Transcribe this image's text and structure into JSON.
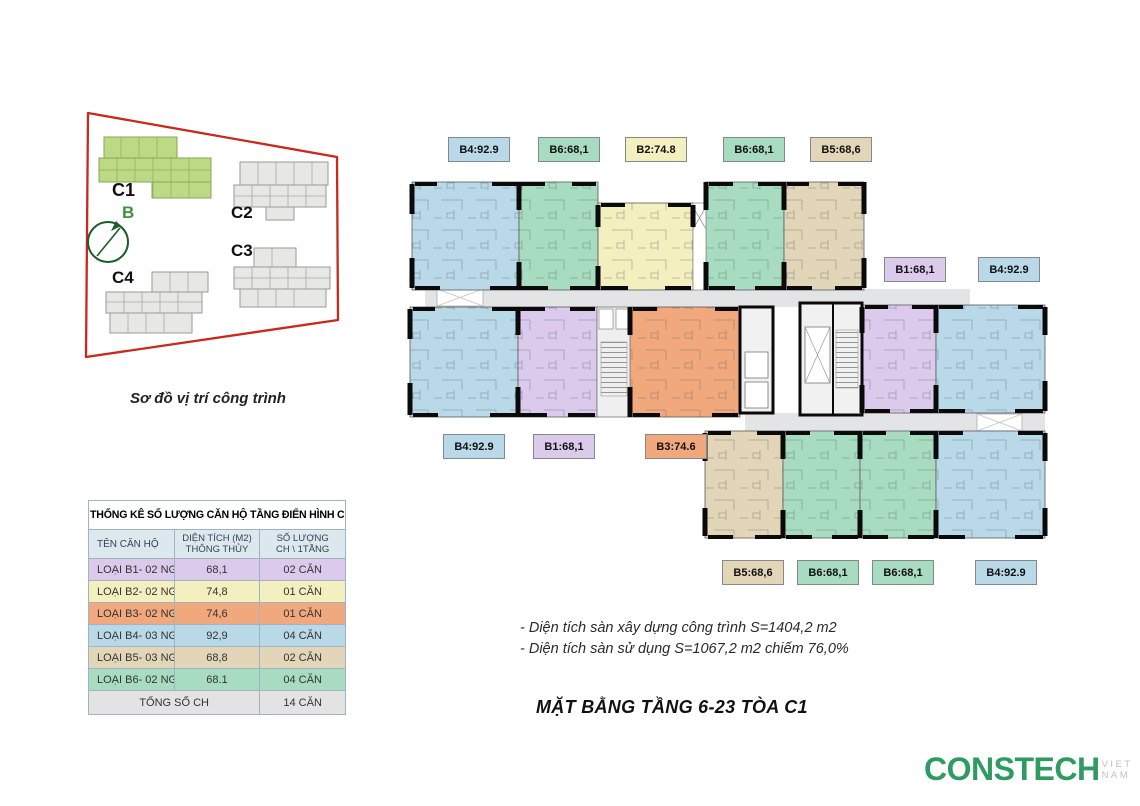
{
  "site_map": {
    "caption": "Sơ đồ vị trí công trình",
    "north_label": "B",
    "buildings": [
      {
        "label": "C1",
        "highlighted": true
      },
      {
        "label": "C2",
        "highlighted": false
      },
      {
        "label": "C3",
        "highlighted": false
      },
      {
        "label": "C4",
        "highlighted": false
      }
    ]
  },
  "plan": {
    "labels": [
      {
        "text": "B4:92.9",
        "type": "b4"
      },
      {
        "text": "B6:68,1",
        "type": "b6"
      },
      {
        "text": "B2:74.8",
        "type": "b2"
      },
      {
        "text": "B6:68,1",
        "type": "b6"
      },
      {
        "text": "B5:68,6",
        "type": "b5"
      },
      {
        "text": "B1:68,1",
        "type": "b1"
      },
      {
        "text": "B4:92.9",
        "type": "b4"
      },
      {
        "text": "B4:92.9",
        "type": "b4"
      },
      {
        "text": "B1:68,1",
        "type": "b1"
      },
      {
        "text": "B3:74.6",
        "type": "b3"
      },
      {
        "text": "B5:68,6",
        "type": "b5"
      },
      {
        "text": "B6:68,1",
        "type": "b6"
      },
      {
        "text": "B6:68,1",
        "type": "b6"
      },
      {
        "text": "B4:92.9",
        "type": "b4"
      }
    ]
  },
  "table": {
    "title": "THỐNG KÊ SỐ LƯỢNG CĂN HỘ TẦNG ĐIỂN HÌNH C1",
    "col_name": "TÊN CĂN HỘ",
    "col_area_1": "DIỆN TÍCH (M2)",
    "col_area_2": "THÔNG THỦY",
    "col_count_1": "SỐ LƯỢNG",
    "col_count_2": "CH \\ 1TẦNG",
    "rows": [
      {
        "name": "LOẠI B1- 02 NGỦ",
        "area": "68,1",
        "count": "02 CĂN",
        "type": "b1"
      },
      {
        "name": "LOẠI B2- 02 NGỦ+",
        "area": "74,8",
        "count": "01 CĂN",
        "type": "b2"
      },
      {
        "name": "LOẠI B3- 02 NGỦ+",
        "area": "74,6",
        "count": "01 CĂN",
        "type": "b3"
      },
      {
        "name": "LOẠI B4- 03 NGỦ",
        "area": "92,9",
        "count": "04 CĂN",
        "type": "b4"
      },
      {
        "name": "LOẠI B5- 03 NGỦ",
        "area": "68,8",
        "count": "02 CĂN",
        "type": "b5"
      },
      {
        "name": "LOẠI B6- 02 NGỦ",
        "area": "68.1",
        "count": "04 CĂN",
        "type": "b6"
      }
    ],
    "total_label": "TỔNG SỐ CH",
    "total_value": "14 CĂN"
  },
  "notes": {
    "line1": "- Diện tích sàn xây dựng công trình S=1404,2 m2",
    "line2": "- Diện tích sàn sử dụng S=1067,2 m2 chiếm 76,0%"
  },
  "main_title": "MẶT BẰNG TẦNG 6-23 TÒA C1",
  "logo": {
    "brand": "CONSTECH",
    "suffix": "VIET NAM"
  },
  "colors": {
    "b1": "#dccaec",
    "b2": "#f4efbe",
    "b3": "#f2a87d",
    "b4": "#b9d9e9",
    "b5": "#e3d6b8",
    "b6": "#a8dcc0",
    "header_row": "#dde7ee",
    "total_row": "#e3e3e3",
    "corridor": "#e3e4e6",
    "red_boundary": "#c8281e",
    "c1_green": "#bcda86",
    "map_gray": "#e7e7e3",
    "logo_green": "#2e9c62",
    "logo_gray": "#bdc2c4",
    "compass_green": "#1d5c2c",
    "north_green": "#3e9140"
  }
}
